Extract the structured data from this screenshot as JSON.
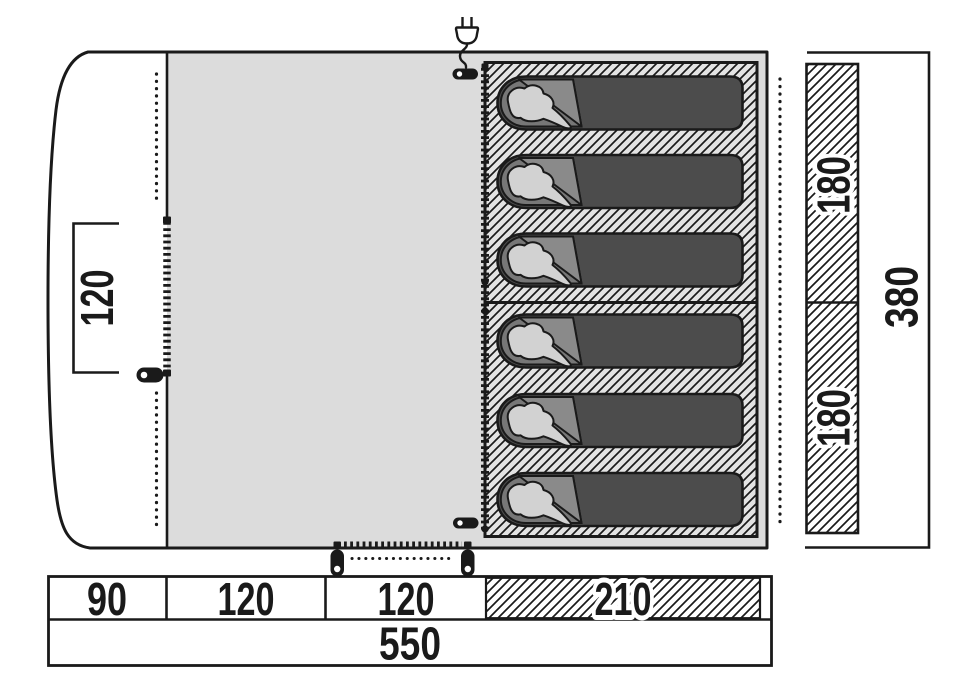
{
  "diagram": {
    "type": "tent-floorplan-top-view",
    "labels": {
      "porch_width": "120",
      "width_seg_1": "90",
      "width_seg_2": "120",
      "width_seg_3": "120",
      "width_seg_4": "210",
      "width_total": "550",
      "cabin_depth_top": "180",
      "cabin_depth_bottom": "180",
      "depth_total": "380"
    },
    "icons": {
      "power_plug": "mains-plug-with-cable",
      "cable_entry": "black-pill-with-eyelet",
      "zipper_pull": "zipper-slider-with-eyelet",
      "sleeping_bag": "sleeping-bag-with-person-silhouette"
    },
    "features": {
      "sleeping_bag_count": 6,
      "bedroom_count": 2
    },
    "colors": {
      "ink": "#1a1a1a",
      "canvas": "#ffffff",
      "living_area": "#dcdcdc",
      "inner_tent_bg": "#e3e3e3",
      "sleeping_bag_body": "#4c4c4c",
      "sleeping_bag_open": "#777777",
      "sleeping_bag_flap": "#8a8a8a",
      "sleeping_bag_liner": "#d2d2d2"
    }
  }
}
